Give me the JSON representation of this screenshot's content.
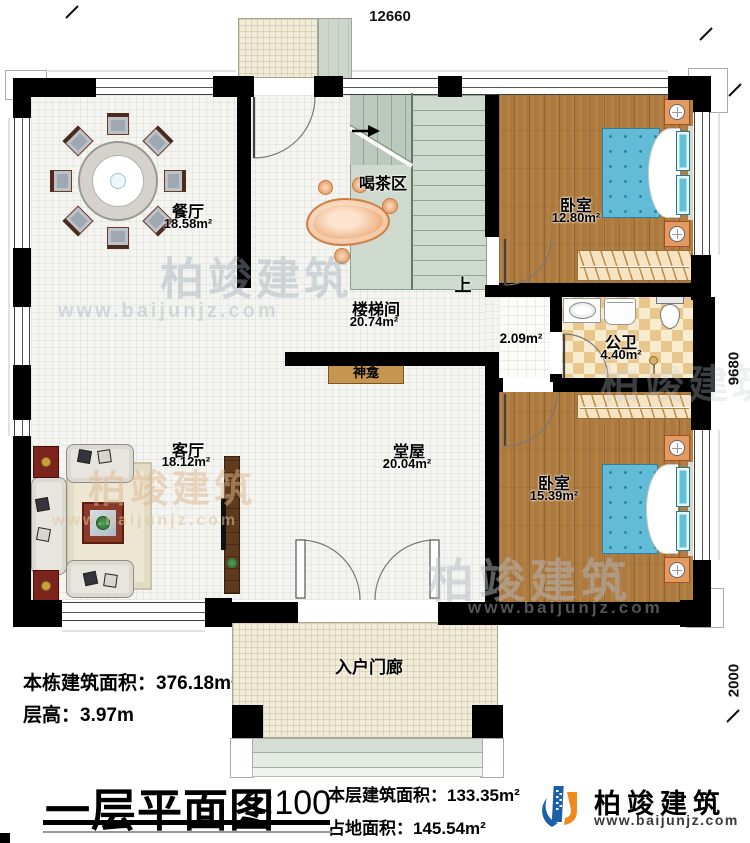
{
  "dimensions": {
    "top": "12660",
    "right_upper": "9680",
    "right_lower": "2000"
  },
  "rooms": {
    "dining": {
      "name": "餐厅",
      "area": "18.58m²"
    },
    "tea_area": {
      "name": "喝茶区"
    },
    "stairwell": {
      "name": "楼梯间",
      "area": "20.74m²",
      "up": "上"
    },
    "bedroom_top": {
      "name": "卧室",
      "area": "12.80m²"
    },
    "bathroom": {
      "name": "公卫",
      "area": "4.40m²"
    },
    "nook": {
      "area": "2.09m²"
    },
    "living": {
      "name": "客厅",
      "area": "18.12m²"
    },
    "hall": {
      "name": "堂屋",
      "area": "20.04m²"
    },
    "shrine": {
      "name": "神龛"
    },
    "bedroom_bottom": {
      "name": "卧室",
      "area": "15.39m²"
    },
    "porch": {
      "name": "入户门廊"
    }
  },
  "info": {
    "building_area_label": "本栋建筑面积：",
    "building_area_value": "376.18m²",
    "floor_height_label": "层高：",
    "floor_height_value": "3.97m"
  },
  "titleblock": {
    "title": "一层平面图",
    "scale": "1:100",
    "floor_area_label": "本层建筑面积：",
    "floor_area_value": "133.35m²",
    "land_area_label": "占地面积：",
    "land_area_value": "145.54m²"
  },
  "brand": {
    "name": "柏竣建筑",
    "url": "www.baijunjz.com"
  }
}
